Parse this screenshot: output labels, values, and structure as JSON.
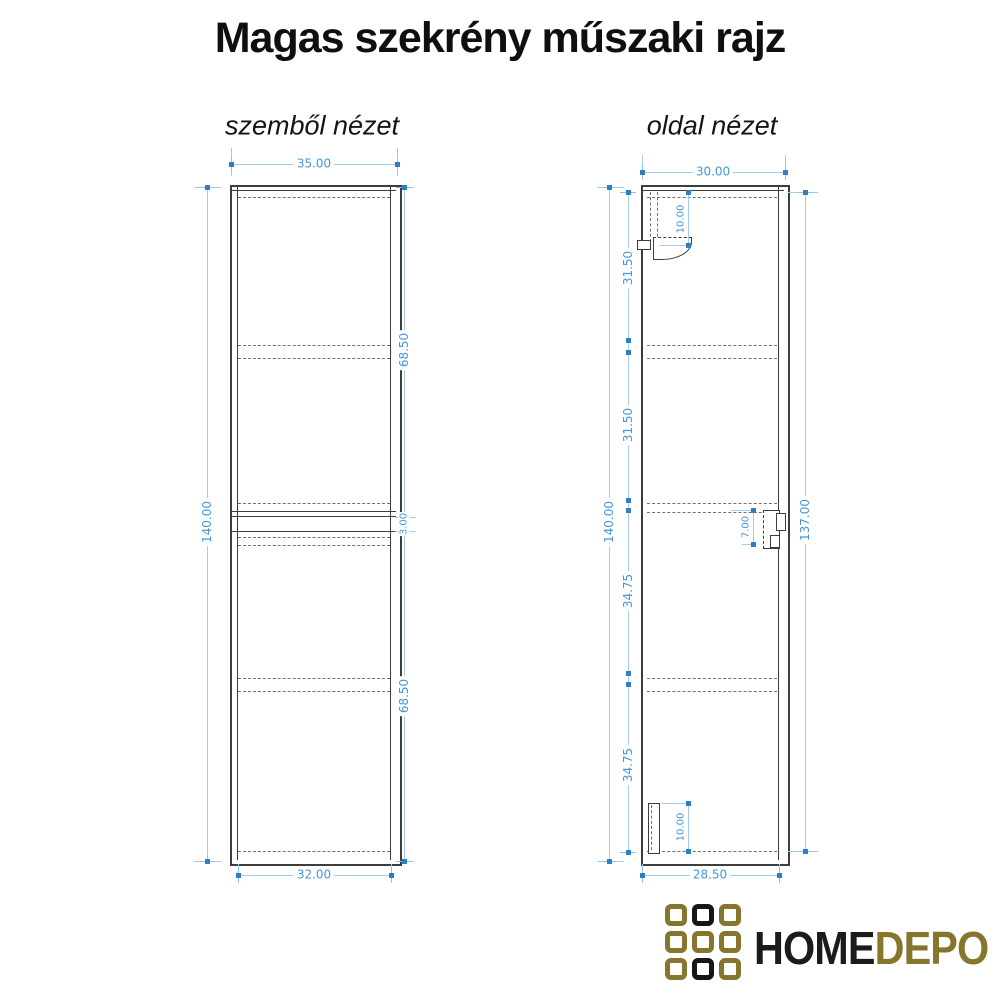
{
  "title": "Magas szekrény műszaki rajz",
  "views": {
    "front": {
      "label": "szemből nézet",
      "dims": {
        "top": "35.00",
        "bottom": "32.00",
        "left": "140.00",
        "right_top": "68.50",
        "right_mid": "3.00",
        "right_bottom": "68.50"
      }
    },
    "side": {
      "label": "oldal nézet",
      "dims": {
        "top": "30.00",
        "bottom": "28.50",
        "left_overall": "140.00",
        "sections": [
          "31.50",
          "31.50",
          "34.75",
          "34.75"
        ],
        "right": "137.00",
        "bracket_top": "10.00",
        "bracket_mid": "7.00",
        "bracket_bottom": "10.00"
      }
    }
  },
  "logo": {
    "text_primary": "HOME",
    "text_secondary": "DEPO",
    "grid_pattern": [
      [
        "gold",
        "black",
        "gold"
      ],
      [
        "gold",
        "gold",
        "gold"
      ],
      [
        "gold",
        "black",
        "gold"
      ]
    ],
    "colors": {
      "gold": "#86752c",
      "black": "#161616"
    }
  },
  "colors": {
    "dimension_line": "#a5cbe9",
    "dimension_text": "#4597d7",
    "drawing_line": "#3d3d3d",
    "background": "#ffffff"
  }
}
